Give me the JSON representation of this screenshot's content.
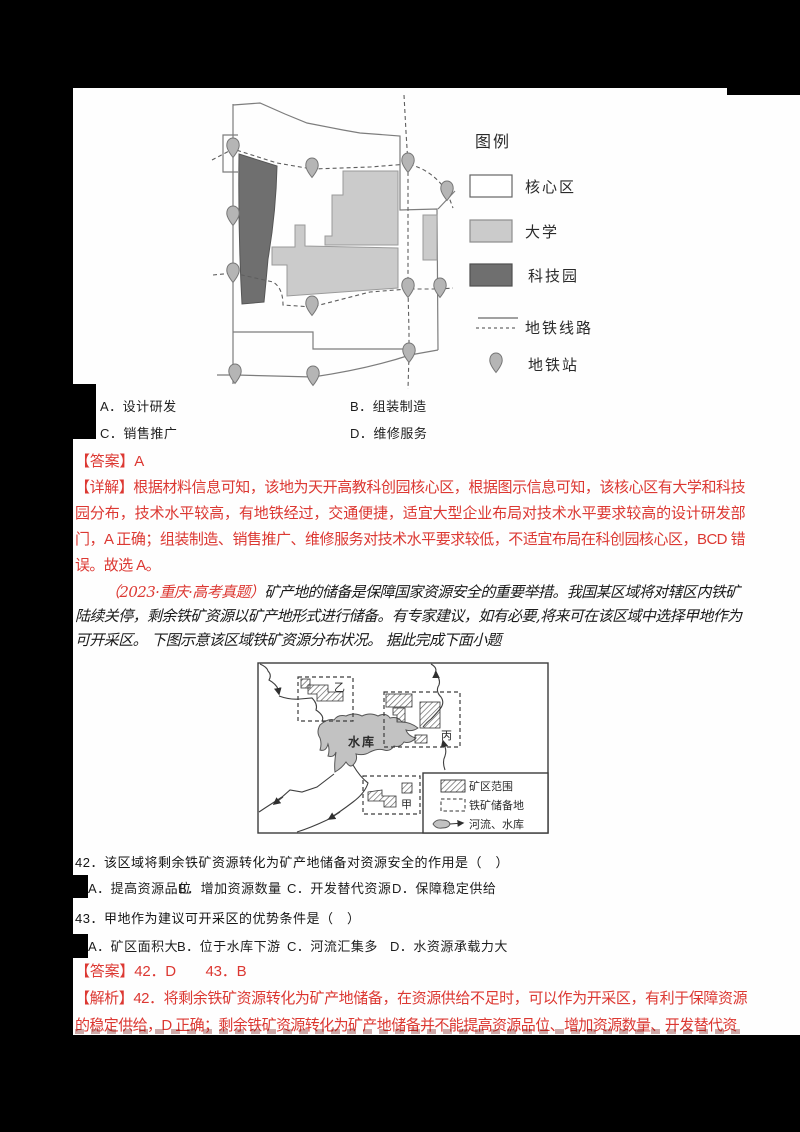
{
  "colors": {
    "accent_red": "#dc3832",
    "university_gray": "#cbcbcb",
    "techpark_gray": "#6f6f6f",
    "reservoir_gray": "#c2c2c2"
  },
  "question41": {
    "options": [
      "A．设计研发",
      "B．组装制造",
      "C．销售推广",
      "D．维修服务"
    ],
    "answer": "【答案】A",
    "explanation": "【详解】根据材料信息可知，该地为天开高教科创园核心区，根据图示信息可知，该核心区有大学和科技园分布，技术水平较高，有地铁经过，交通便捷，适宜大型企业布局对技术水平要求较高的设计研发部门，A 正确；组装制造、销售推广、维修服务对技术水平要求较低，不适宜布局在科创园核心区，BCD 错误。故选 A。"
  },
  "map1": {
    "legend_title": "图例",
    "legend_core": "核心区",
    "legend_university": "大学",
    "legend_techpark": "科技园",
    "legend_subway_line": "地铁线路",
    "legend_subway_station": "地铁站"
  },
  "passage": {
    "source": "（2023·重庆·高考真题）",
    "text": "矿产地的储备是保障国家资源安全的重要举措。我国某区域将对辖区内铁矿陆续关停，剩余铁矿资源以矿产地形式进行储备。有专家建议，如有必要,将来可在该区域中选择甲地作为可开采区。 下图示意该区域铁矿资源分布状况。 据此完成下面小题"
  },
  "map2": {
    "reservoir_label": "水库",
    "area_yi": "乙",
    "area_bing": "丙",
    "area_jia": "甲",
    "legend_mining_area": "矿区范围",
    "legend_reserve_site": "铁矿储备地",
    "legend_river_reservoir": "河流、水库"
  },
  "question42": {
    "text": "42．该区域将剩余铁矿资源转化为矿产地储备对资源安全的作用是（　）",
    "options": [
      "A．提高资源品位",
      "B．增加资源数量",
      "C．开发替代资源",
      "D．保障稳定供给"
    ]
  },
  "question43": {
    "text": "43．甲地作为建议可开采区的优势条件是（　）",
    "options": [
      "A．矿区面积大",
      "B．位于水库下游",
      "C．河流汇集多",
      "D．水资源承载力大"
    ]
  },
  "answers_bottom": "【答案】42．D　　43．B",
  "analysis_bottom": "【解析】42．将剩余铁矿资源转化为矿产地储备，在资源供给不足时，可以作为开采区，有利于保障资源的稳定供给，D 正确；剩余铁矿资源转化为矿产地储备并不能提高资源品位、增加资源数量、开发替代资"
}
